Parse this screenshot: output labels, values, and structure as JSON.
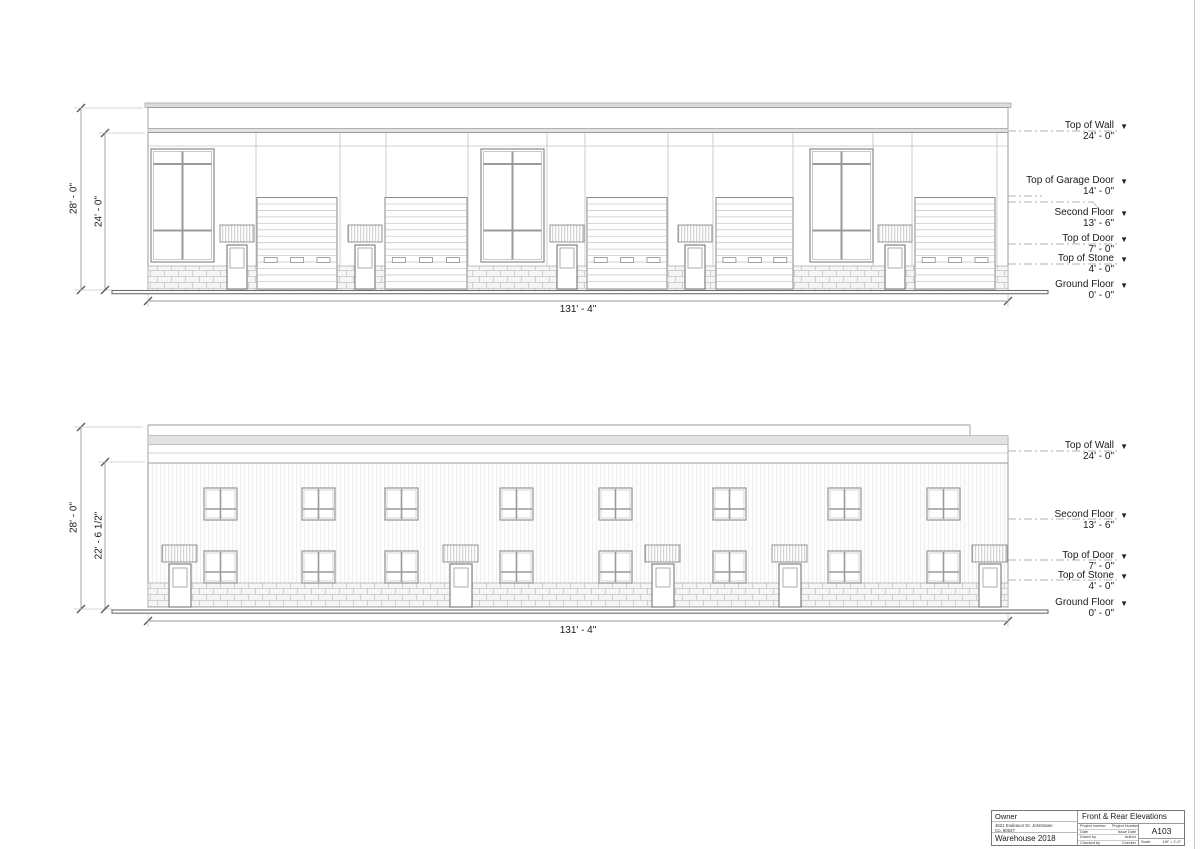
{
  "sheet": {
    "owner_label": "Owner",
    "address_line1": "4521 Endeavor Dr. Johnstown",
    "address_line2": "Co. 80537",
    "project_name": "Warehouse 2018",
    "title": "Front & Rear Elevations",
    "number": "A103",
    "scale_label": "Scale",
    "scale": "1/8\" = 1'-0\"",
    "fields": [
      {
        "label": "Project number",
        "value": "Project Number"
      },
      {
        "label": "Date",
        "value": "Issue Date"
      },
      {
        "label": "Drawn by",
        "value": "Author"
      },
      {
        "label": "Checked by",
        "value": "Checker"
      }
    ]
  },
  "front_elevation": {
    "dim_width": "131' - 4\"",
    "dim_height_outer": "28' - 0\"",
    "dim_height_inner": "24' - 0\"",
    "marker_glyph": "▼",
    "levels": [
      {
        "name": "Top of Wall",
        "value": "24' - 0\""
      },
      {
        "name": "Top of Garage Door",
        "value": "14' - 0\""
      },
      {
        "name": "Second Floor",
        "value": "13' - 6\""
      },
      {
        "name": "Top of Door",
        "value": "7' - 0\""
      },
      {
        "name": "Top of Stone",
        "value": "4' - 0\""
      },
      {
        "name": "Ground Floor",
        "value": "0' - 0\""
      }
    ]
  },
  "rear_elevation": {
    "dim_width": "131' - 4\"",
    "dim_height_outer": "28' - 0\"",
    "dim_height_inner": "22' - 6 1/2\"",
    "levels": [
      {
        "name": "Top of Wall",
        "value": "24' - 0\""
      },
      {
        "name": "Second Floor",
        "value": "13' - 6\""
      },
      {
        "name": "Top of Door",
        "value": "7' - 0\""
      },
      {
        "name": "Top of Stone",
        "value": "4' - 0\""
      },
      {
        "name": "Ground Floor",
        "value": "0' - 0\""
      }
    ]
  }
}
